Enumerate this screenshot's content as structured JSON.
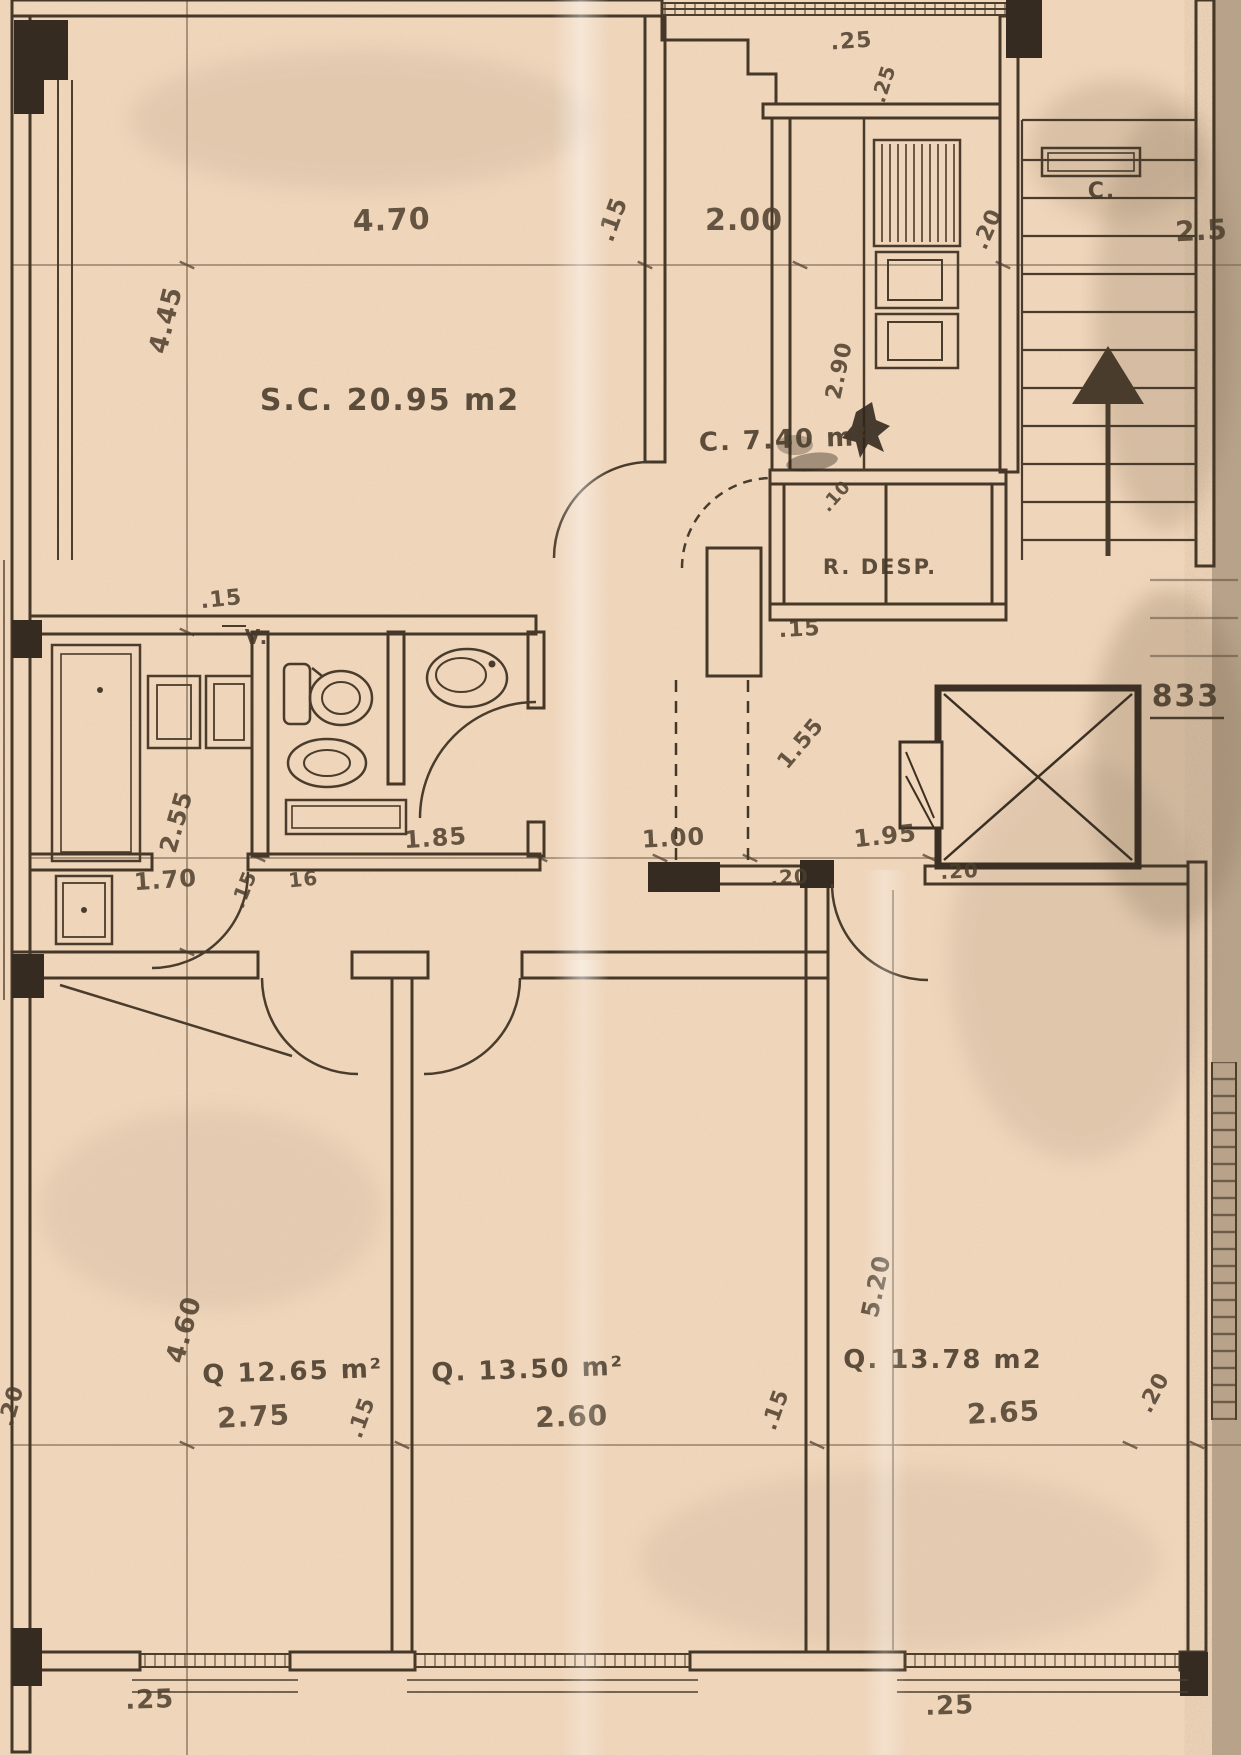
{
  "colors": {
    "paper": "#f1d7bc",
    "ink": "#453828",
    "pier": "#352b20",
    "scan_shadow": "#8a7560"
  },
  "plan": {
    "sheet_number": "833",
    "rooms": {
      "living": {
        "label": "S.C. 20.95 m2"
      },
      "kitchen": {
        "label": "C. 7.40 m²"
      },
      "closet": {
        "label": "C."
      },
      "pantry": {
        "label": "R. DESP."
      },
      "bedroom_1": {
        "label": "Q 12.65 m²"
      },
      "bedroom_2": {
        "label": "Q. 13.50 m²"
      },
      "bedroom_3": {
        "label": "Q. 13.78 m2"
      },
      "vent": {
        "label": "V."
      }
    },
    "dimension_labels": [
      {
        "t": "4.70",
        "x": 392,
        "y": 230,
        "r": -2,
        "s": 30
      },
      {
        "t": ".15",
        "x": 620,
        "y": 222,
        "r": -70,
        "s": 24
      },
      {
        "t": "2.00",
        "x": 744,
        "y": 230,
        "r": 0,
        "s": 30
      },
      {
        "t": ".25",
        "x": 852,
        "y": 48,
        "r": -4,
        "s": 22
      },
      {
        "t": ".25",
        "x": 890,
        "y": 86,
        "r": -72,
        "s": 20
      },
      {
        "t": ".20",
        "x": 994,
        "y": 232,
        "r": -66,
        "s": 22
      },
      {
        "t": "2.5",
        "x": 1202,
        "y": 240,
        "r": -3,
        "s": 28
      },
      {
        "t": "2.90",
        "x": 846,
        "y": 372,
        "r": -78,
        "s": 22
      },
      {
        "t": ".10",
        "x": 840,
        "y": 500,
        "r": -48,
        "s": 18
      },
      {
        "t": ".15",
        "x": 800,
        "y": 636,
        "r": -3,
        "s": 22
      },
      {
        "t": "4.45",
        "x": 174,
        "y": 322,
        "r": -76,
        "s": 26
      },
      {
        "t": ".15",
        "x": 222,
        "y": 606,
        "r": -6,
        "s": 22
      },
      {
        "t": "2.55",
        "x": 184,
        "y": 824,
        "r": -74,
        "s": 24
      },
      {
        "t": "1.85",
        "x": 436,
        "y": 846,
        "r": -4,
        "s": 24
      },
      {
        "t": "1.00",
        "x": 674,
        "y": 846,
        "r": -3,
        "s": 24
      },
      {
        "t": "1.55",
        "x": 806,
        "y": 748,
        "r": -50,
        "s": 22
      },
      {
        "t": "1.95",
        "x": 886,
        "y": 844,
        "r": -6,
        "s": 24
      },
      {
        "t": ".20",
        "x": 790,
        "y": 884,
        "r": -3,
        "s": 20
      },
      {
        "t": ".20",
        "x": 960,
        "y": 878,
        "r": -3,
        "s": 20
      },
      {
        "t": "1.70",
        "x": 166,
        "y": 888,
        "r": -4,
        "s": 24
      },
      {
        "t": ".15",
        "x": 250,
        "y": 892,
        "r": -68,
        "s": 20
      },
      {
        "t": "16",
        "x": 304,
        "y": 886,
        "r": -6,
        "s": 20
      },
      {
        "t": "4.60",
        "x": 192,
        "y": 1332,
        "r": -74,
        "s": 26
      },
      {
        "t": ".20",
        "x": 18,
        "y": 1408,
        "r": -74,
        "s": 22
      },
      {
        "t": "5.20",
        "x": 884,
        "y": 1288,
        "r": -78,
        "s": 24
      },
      {
        "t": "2.75",
        "x": 254,
        "y": 1426,
        "r": -3,
        "s": 28
      },
      {
        "t": ".15",
        "x": 368,
        "y": 1420,
        "r": -70,
        "s": 22
      },
      {
        "t": "2.60",
        "x": 572,
        "y": 1426,
        "r": -2,
        "s": 28
      },
      {
        "t": ".15",
        "x": 782,
        "y": 1412,
        "r": -70,
        "s": 22
      },
      {
        "t": "2.65",
        "x": 1004,
        "y": 1422,
        "r": -3,
        "s": 28
      },
      {
        "t": ".20",
        "x": 1160,
        "y": 1396,
        "r": -62,
        "s": 22
      },
      {
        "t": ".25",
        "x": 150,
        "y": 1708,
        "r": -2,
        "s": 26
      },
      {
        "t": ".25",
        "x": 950,
        "y": 1714,
        "r": -2,
        "s": 26
      }
    ]
  }
}
